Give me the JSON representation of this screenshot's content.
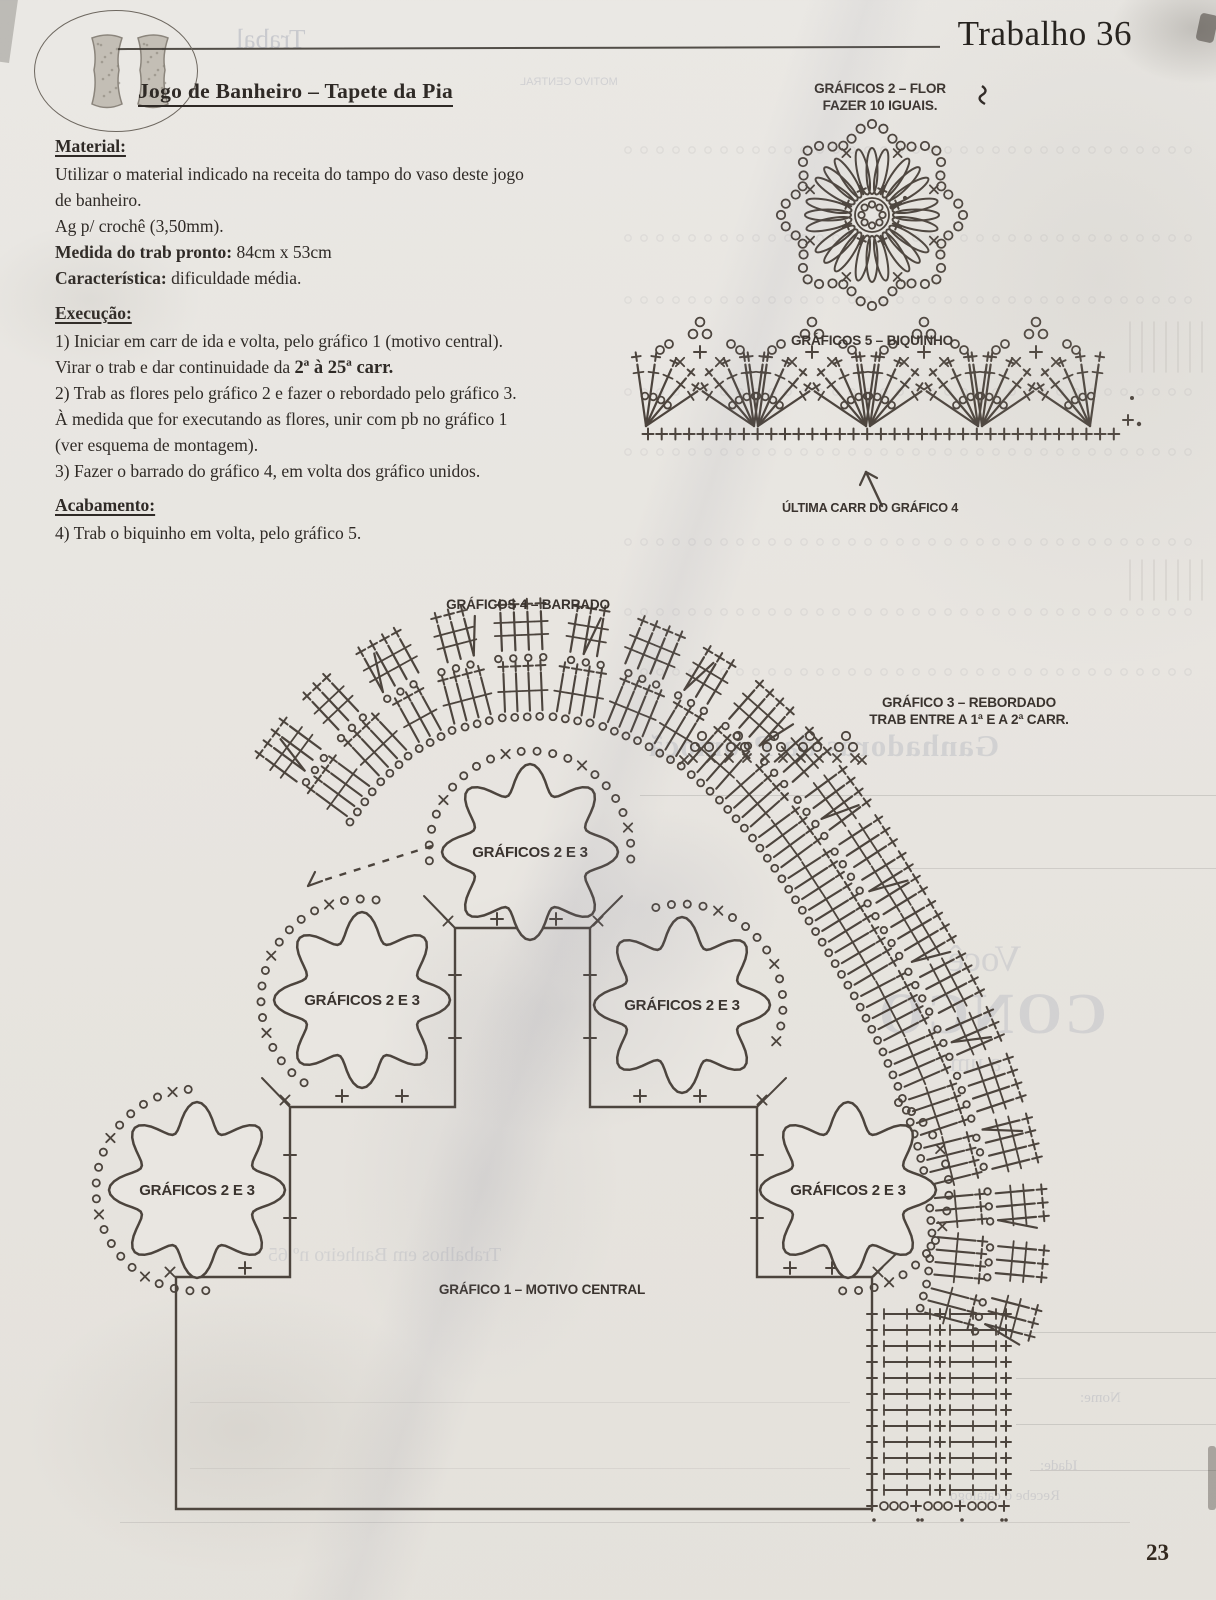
{
  "colors": {
    "paper": "#e9e6e1",
    "ink": "#332c27",
    "diagram_ink": "#4c443d",
    "ghost": "#a2a6b4"
  },
  "page": {
    "header_title": "Trabalho 36",
    "number": "23"
  },
  "article": {
    "title": "Jogo de Banheiro – Tapete da Pia",
    "material": {
      "heading": "Material:",
      "line1": "Utilizar o material indicado na receita do tampo do vaso deste jogo",
      "line2": "de banheiro.",
      "line3": "Ag p/ crochê (3,50mm).",
      "line4_label": "Medida do trab pronto:",
      "line4_value": " 84cm x 53cm",
      "line5_label": "Característica:",
      "line5_value": " dificuldade média."
    },
    "execucao": {
      "heading": "Execução:",
      "step1": "1) Iniciar em carr de ida e volta, pelo gráfico 1 (motivo central).",
      "step1b_prefix": "Virar o trab e dar continuidade da ",
      "step1b_bold": "2ª à 25ª carr.",
      "step2": "2) Trab as flores pelo gráfico 2 e fazer o rebordado pelo gráfico 3.",
      "step2b": "À medida que for executando as flores, unir com pb no gráfico 1",
      "step2c": "(ver esquema de montagem).",
      "step3": "3) Fazer o barrado do gráfico 4, em volta dos gráfico unidos."
    },
    "acabamento": {
      "heading": "Acabamento:",
      "step4": "4) Trab o biquinho em volta, pelo gráfico 5."
    }
  },
  "diagrams": {
    "grafico2": {
      "label_line1": "GRÁFICOS 2 – FLOR",
      "label_line2": "FAZER 10 IGUAIS."
    },
    "grafico5": {
      "label": "GRÁFICOS 5 – BIQUINHO",
      "arrow_label": "ÚLTIMA CARR DO GRÁFICO 4"
    },
    "grafico4": {
      "label": "GRÁFICOS 4 – BARRADO"
    },
    "grafico3": {
      "label_line1": "GRÁFICO 3 – REBORDADO",
      "label_line2": "TRAB ENTRE A 1ª E A 2ª CARR."
    },
    "grafico1": {
      "label": "GRÁFICO 1 – MOTIVO CENTRAL"
    },
    "motif_label": "GRÁFICOS 2 E 3"
  },
  "ghost_text": {
    "masthead": "Trabal",
    "motivo": "MOTIVO CENTRAL",
    "ganhadoras": "Ganhadoras da Promoçã",
    "voce": "Você",
    "conco": "CONCO",
    "a_um": "a um",
    "trabalhos": "Trabalhos em Banheiro nº 65",
    "nome": "Nome:",
    "idade": "Idade:",
    "recebe": "Recebe o catálogo"
  }
}
